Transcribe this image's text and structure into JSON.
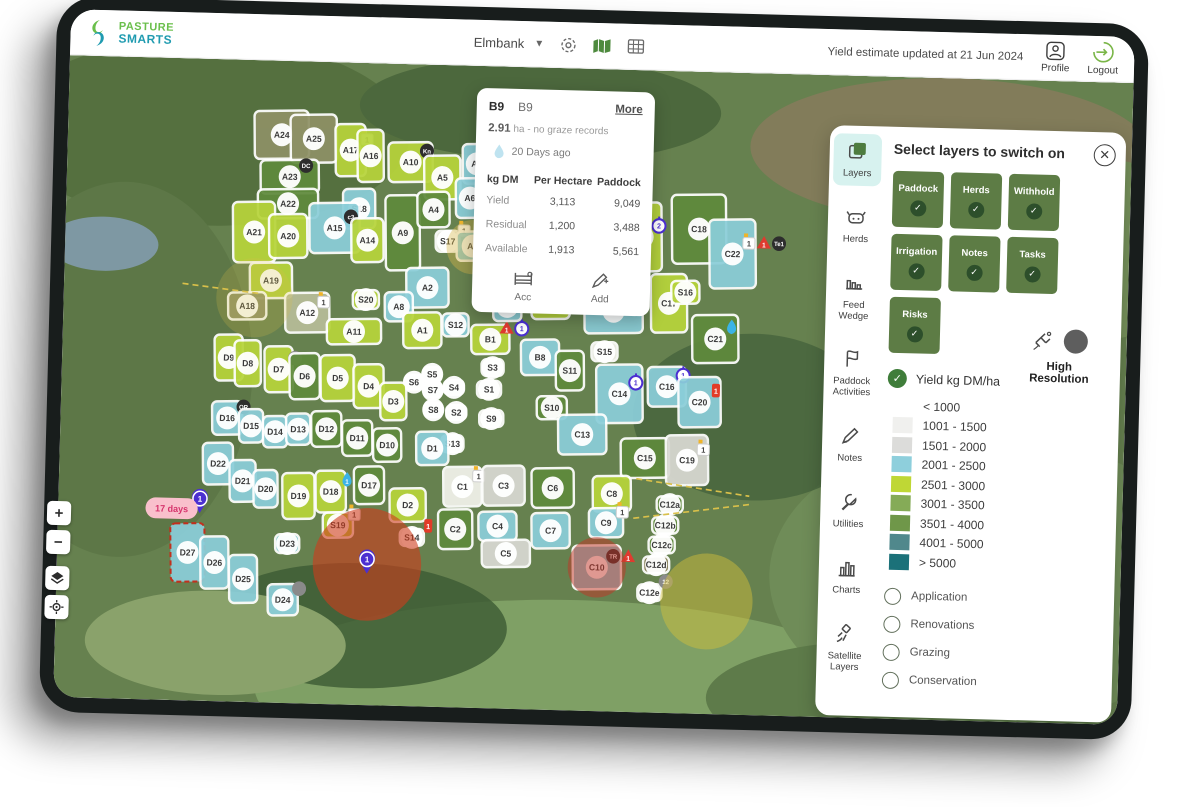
{
  "header": {
    "brand_line1": "PASTURE",
    "brand_line2": "SMARTS",
    "farm_selector": "Elmbank",
    "updated_text": "Yield estimate updated at 21 Jun 2024",
    "profile_label": "Profile",
    "logout_label": "Logout"
  },
  "popup": {
    "tab1": "B9",
    "tab2": "B9",
    "more_label": "More",
    "area_value": "2.91",
    "area_rest": " ha - no graze records",
    "days_ago": "20 Days ago",
    "table": {
      "col1": "kg DM",
      "col2": "Per Hectare",
      "col3": "Paddock",
      "rows": [
        {
          "label": "Yield",
          "per_hectare": "3,113",
          "paddock": "9,049"
        },
        {
          "label": "Residual",
          "per_hectare": "1,200",
          "paddock": "3,488"
        },
        {
          "label": "Available",
          "per_hectare": "1,913",
          "paddock": "5,561"
        }
      ]
    },
    "actions": [
      {
        "label": "Acc",
        "icon": "gate-icon"
      },
      {
        "label": "Add",
        "icon": "edit-icon"
      }
    ]
  },
  "layers_panel": {
    "title": "Select layers to switch on",
    "rail": [
      {
        "label": "Layers",
        "icon": "layers-icon",
        "active": true
      },
      {
        "label": "Herds",
        "icon": "herds-icon",
        "active": false
      },
      {
        "label": "Feed Wedge",
        "icon": "feed-wedge-icon",
        "active": false
      },
      {
        "label": "Paddock Activities",
        "icon": "paddock-activities-icon",
        "active": false
      },
      {
        "label": "Notes",
        "icon": "notes-icon",
        "active": false
      },
      {
        "label": "Utilities",
        "icon": "utilities-icon",
        "active": false
      },
      {
        "label": "Charts",
        "icon": "charts-icon",
        "active": false
      },
      {
        "label": "Satellite Layers",
        "icon": "satellite-layers-icon",
        "active": false
      }
    ],
    "toggles": [
      "Paddock",
      "Herds",
      "Withhold",
      "Irrigation",
      "Notes",
      "Tasks",
      "Risks"
    ],
    "toggle_bg": "#5d7c45",
    "toggle_check_bg": "#2d4f2b",
    "yield_checkbox_label": "Yield kg DM/ha",
    "yield_check_color": "#3f7d3a",
    "high_resolution_label": "High Resolution",
    "high_resolution_dot_color": "#5e5e5e",
    "legend": [
      {
        "label": "< 1000",
        "color": "#ffffff"
      },
      {
        "label": "1001 - 1500",
        "color": "#f0f0ee"
      },
      {
        "label": "1501 - 2000",
        "color": "#dcdcda"
      },
      {
        "label": "2001 - 2500",
        "color": "#8ecfdc"
      },
      {
        "label": "2501 - 3000",
        "color": "#bfd735"
      },
      {
        "label": "3001 - 3500",
        "color": "#85ab57"
      },
      {
        "label": "3501 - 4000",
        "color": "#6f9749"
      },
      {
        "label": "4001 - 5000",
        "color": "#50888c"
      },
      {
        "label": "> 5000",
        "color": "#1b7179"
      }
    ],
    "options": [
      "Application",
      "Renovations",
      "Grazing",
      "Conservation"
    ]
  },
  "map": {
    "scale_label": "100 m",
    "zoom_in": "+",
    "zoom_out": "−",
    "days_pill": "17 days",
    "colors": {
      "lime": "#b7d43b",
      "dgreen": "#5f8a3c",
      "green": "#7da653",
      "blue": "#8bced9",
      "gray": "#d9d9d3",
      "white": "#f2f2ec",
      "olive": "#8e9166",
      "khaki": "#b7bd99",
      "brown": "#8a7f5a"
    },
    "risk_color": "#cf3c1c",
    "irrigation_color": "#d6c23a",
    "paddocks": [
      {
        "id": "A24",
        "x": 213,
        "y": 71,
        "w": 54,
        "h": 46,
        "c": "olive"
      },
      {
        "id": "A25",
        "x": 245,
        "y": 74,
        "w": 46,
        "h": 46,
        "c": "olive"
      },
      {
        "id": "A17",
        "x": 282,
        "y": 84,
        "w": 30,
        "h": 50,
        "c": "lime",
        "b": [
          "f:1"
        ]
      },
      {
        "id": "A16",
        "x": 302,
        "y": 89,
        "w": 26,
        "h": 50,
        "c": "lime"
      },
      {
        "id": "A10",
        "x": 342,
        "y": 94,
        "w": 44,
        "h": 38,
        "c": "lime",
        "b": [
          "k:Kn"
        ]
      },
      {
        "id": "A5",
        "x": 374,
        "y": 108,
        "w": 36,
        "h": 42,
        "c": "lime"
      },
      {
        "id": "A7",
        "x": 408,
        "y": 94,
        "w": 28,
        "h": 38,
        "c": "blue"
      },
      {
        "id": "A23",
        "x": 222,
        "y": 111,
        "w": 58,
        "h": 32,
        "c": "dgreen",
        "b": [
          "k:DC"
        ]
      },
      {
        "id": "A22",
        "x": 221,
        "y": 137,
        "w": 60,
        "h": 28,
        "c": "dgreen"
      },
      {
        "id": "A21",
        "x": 188,
        "y": 165,
        "w": 42,
        "h": 58,
        "c": "lime"
      },
      {
        "id": "A20",
        "x": 222,
        "y": 168,
        "w": 38,
        "h": 42,
        "c": "lime"
      },
      {
        "id": "S18",
        "x": 292,
        "y": 140,
        "w": 32,
        "h": 38,
        "c": "blue"
      },
      {
        "id": "A15",
        "x": 268,
        "y": 159,
        "w": 50,
        "h": 48,
        "c": "blue",
        "b": [
          "k:c3"
        ]
      },
      {
        "id": "A14",
        "x": 301,
        "y": 170,
        "w": 32,
        "h": 42,
        "c": "lime"
      },
      {
        "id": "A9",
        "x": 336,
        "y": 162,
        "w": 34,
        "h": 72,
        "c": "dgreen"
      },
      {
        "id": "A4",
        "x": 366,
        "y": 139,
        "w": 32,
        "h": 34,
        "c": "dgreen"
      },
      {
        "id": "A6",
        "x": 402,
        "y": 127,
        "w": 28,
        "h": 38,
        "c": "blue"
      },
      {
        "id": "A19",
        "x": 206,
        "y": 211,
        "w": 42,
        "h": 34,
        "c": "lime"
      },
      {
        "id": "A18",
        "x": 183,
        "y": 236,
        "w": 38,
        "h": 26,
        "c": "olive"
      },
      {
        "id": "A12",
        "x": 243,
        "y": 241,
        "w": 44,
        "h": 38,
        "c": "khaki",
        "b": [
          "f:1"
        ]
      },
      {
        "id": "S20",
        "x": 301,
        "y": 227,
        "w": 26,
        "h": 18,
        "c": "lime"
      },
      {
        "id": "S17",
        "x": 381,
        "y": 169,
        "w": 24,
        "h": 20,
        "c": "white",
        "b": [
          "f:1"
        ]
      },
      {
        "id": "A3",
        "x": 406,
        "y": 173,
        "w": 32,
        "h": 28,
        "c": "blue",
        "b": [
          "s:1",
          "r:1"
        ]
      },
      {
        "id": "A2",
        "x": 362,
        "y": 214,
        "w": 42,
        "h": 38,
        "c": "blue"
      },
      {
        "id": "A8",
        "x": 334,
        "y": 233,
        "w": 28,
        "h": 28,
        "c": "blue"
      },
      {
        "id": "A1",
        "x": 358,
        "y": 255,
        "w": 38,
        "h": 34,
        "c": "lime"
      },
      {
        "id": "S12",
        "x": 391,
        "y": 249,
        "w": 26,
        "h": 22,
        "c": "blue"
      },
      {
        "id": "A11",
        "x": 290,
        "y": 258,
        "w": 54,
        "h": 24,
        "c": "lime"
      },
      {
        "id": "B1",
        "x": 426,
        "y": 262,
        "w": 38,
        "h": 28,
        "c": "lime",
        "b": [
          "w:1",
          "s:1"
        ]
      },
      {
        "id": "B2",
        "x": 442,
        "y": 230,
        "w": 28,
        "h": 28,
        "c": "blue"
      },
      {
        "id": "B9",
        "x": 485,
        "y": 224,
        "w": 38,
        "h": 34,
        "c": "lime",
        "b": [
          "d:20"
        ]
      },
      {
        "id": "B14",
        "x": 548,
        "y": 232,
        "w": 58,
        "h": 42,
        "c": "blue",
        "b": [
          "s:1"
        ]
      },
      {
        "id": "B15",
        "x": 575,
        "y": 160,
        "w": 38,
        "h": 66,
        "c": "lime",
        "b": [
          "s:2"
        ]
      },
      {
        "id": "B8",
        "x": 476,
        "y": 278,
        "w": 38,
        "h": 34,
        "c": "blue"
      },
      {
        "id": "S15",
        "x": 540,
        "y": 271,
        "w": 26,
        "h": 18,
        "c": "white"
      },
      {
        "id": "S11",
        "x": 506,
        "y": 290,
        "w": 28,
        "h": 38,
        "c": "dgreen"
      },
      {
        "id": "S3",
        "x": 429,
        "y": 289,
        "w": 22,
        "h": 16,
        "c": "white"
      },
      {
        "id": "S1",
        "x": 426,
        "y": 310,
        "w": 24,
        "h": 16,
        "c": "white"
      },
      {
        "id": "S4",
        "x": 391,
        "y": 309,
        "w": 20,
        "h": 14,
        "c": "white"
      },
      {
        "id": "S2",
        "x": 394,
        "y": 333,
        "w": 20,
        "h": 14,
        "c": "white"
      },
      {
        "id": "S9",
        "x": 429,
        "y": 338,
        "w": 24,
        "h": 16,
        "c": "white"
      },
      {
        "id": "S10",
        "x": 489,
        "y": 326,
        "w": 30,
        "h": 22,
        "c": "dgreen"
      },
      {
        "id": "S5",
        "x": 369,
        "y": 297,
        "w": 18,
        "h": 14,
        "c": "white"
      },
      {
        "id": "S6",
        "x": 351,
        "y": 305,
        "w": 18,
        "h": 14,
        "c": "white"
      },
      {
        "id": "S7",
        "x": 370,
        "y": 312,
        "w": 18,
        "h": 14,
        "c": "white"
      },
      {
        "id": "S8",
        "x": 371,
        "y": 331,
        "w": 18,
        "h": 14,
        "c": "white"
      },
      {
        "id": "S13",
        "x": 391,
        "y": 363,
        "w": 22,
        "h": 16,
        "c": "white"
      },
      {
        "id": "C17",
        "x": 603,
        "y": 223,
        "w": 36,
        "h": 56,
        "c": "lime"
      },
      {
        "id": "S16",
        "x": 619,
        "y": 212,
        "w": 28,
        "h": 22,
        "c": "lime"
      },
      {
        "id": "C18",
        "x": 631,
        "y": 151,
        "w": 54,
        "h": 66,
        "c": "dgreen"
      },
      {
        "id": "C22",
        "x": 665,
        "y": 174,
        "w": 46,
        "h": 66,
        "c": "blue",
        "b": [
          "f:1",
          "w:1",
          "k:Te1"
        ]
      },
      {
        "id": "C21",
        "x": 650,
        "y": 256,
        "w": 46,
        "h": 46,
        "c": "dgreen",
        "b": [
          "d:"
        ]
      },
      {
        "id": "C16",
        "x": 603,
        "y": 303,
        "w": 38,
        "h": 38,
        "c": "blue",
        "b": [
          "s:1"
        ]
      },
      {
        "id": "C20",
        "x": 636,
        "y": 317,
        "w": 42,
        "h": 48,
        "c": "blue",
        "b": [
          "r:1"
        ]
      },
      {
        "id": "C14",
        "x": 556,
        "y": 311,
        "w": 46,
        "h": 56,
        "c": "blue",
        "b": [
          "s:1"
        ]
      },
      {
        "id": "C13",
        "x": 520,
        "y": 351,
        "w": 48,
        "h": 38,
        "c": "blue"
      },
      {
        "id": "C15",
        "x": 583,
        "y": 372,
        "w": 48,
        "h": 38,
        "c": "dgreen"
      },
      {
        "id": "C19",
        "x": 625,
        "y": 373,
        "w": 42,
        "h": 48,
        "c": "gray",
        "b": [
          "f:1"
        ]
      },
      {
        "id": "C1",
        "x": 402,
        "y": 404,
        "w": 38,
        "h": 38,
        "c": "white",
        "b": [
          "f:1"
        ]
      },
      {
        "id": "C3",
        "x": 443,
        "y": 402,
        "w": 42,
        "h": 38,
        "c": "gray"
      },
      {
        "id": "C6",
        "x": 492,
        "y": 403,
        "w": 42,
        "h": 38,
        "c": "dgreen"
      },
      {
        "id": "C8",
        "x": 551,
        "y": 407,
        "w": 38,
        "h": 34,
        "c": "lime"
      },
      {
        "id": "C9",
        "x": 546,
        "y": 435,
        "w": 34,
        "h": 28,
        "c": "blue",
        "b": [
          "f:1"
        ]
      },
      {
        "id": "C4",
        "x": 438,
        "y": 441,
        "w": 38,
        "h": 28,
        "c": "blue"
      },
      {
        "id": "C7",
        "x": 491,
        "y": 444,
        "w": 38,
        "h": 34,
        "c": "blue"
      },
      {
        "id": "C5",
        "x": 447,
        "y": 467,
        "w": 48,
        "h": 26,
        "c": "gray"
      },
      {
        "id": "C10",
        "x": 538,
        "y": 478,
        "w": 48,
        "h": 42,
        "c": "blue",
        "b": [
          "k:TR",
          "w:1"
        ]
      },
      {
        "id": "C2",
        "x": 396,
        "y": 445,
        "w": 34,
        "h": 38,
        "c": "dgreen"
      },
      {
        "id": "C12a",
        "x": 609,
        "y": 416,
        "w": 26,
        "h": 16,
        "c": "dgreen"
      },
      {
        "id": "C12b",
        "x": 605,
        "y": 436,
        "w": 26,
        "h": 16,
        "c": "dgreen"
      },
      {
        "id": "C12c",
        "x": 602,
        "y": 455,
        "w": 26,
        "h": 16,
        "c": "dgreen"
      },
      {
        "id": "C12d",
        "x": 597,
        "y": 474,
        "w": 26,
        "h": 16,
        "c": "brown"
      },
      {
        "id": "C12e",
        "x": 591,
        "y": 501,
        "w": 24,
        "h": 16,
        "c": "white",
        "b": [
          "m:12"
        ]
      },
      {
        "id": "D9",
        "x": 166,
        "y": 286,
        "w": 28,
        "h": 44,
        "c": "lime"
      },
      {
        "id": "D8",
        "x": 185,
        "y": 291,
        "w": 26,
        "h": 44,
        "c": "lime"
      },
      {
        "id": "D7",
        "x": 216,
        "y": 296,
        "w": 28,
        "h": 44,
        "c": "lime",
        "b": [
          "m:"
        ]
      },
      {
        "id": "D6",
        "x": 242,
        "y": 302,
        "w": 30,
        "h": 44,
        "c": "dgreen"
      },
      {
        "id": "D5",
        "x": 275,
        "y": 303,
        "w": 34,
        "h": 44,
        "c": "lime"
      },
      {
        "id": "D4",
        "x": 306,
        "y": 310,
        "w": 30,
        "h": 42,
        "c": "lime"
      },
      {
        "id": "D3",
        "x": 331,
        "y": 324,
        "w": 26,
        "h": 36,
        "c": "lime"
      },
      {
        "id": "D16",
        "x": 166,
        "y": 344,
        "w": 30,
        "h": 32,
        "c": "blue",
        "b": [
          "k:OR"
        ]
      },
      {
        "id": "D15",
        "x": 190,
        "y": 351,
        "w": 24,
        "h": 32,
        "c": "blue"
      },
      {
        "id": "D14",
        "x": 214,
        "y": 356,
        "w": 24,
        "h": 30,
        "c": "blue"
      },
      {
        "id": "D13",
        "x": 237,
        "y": 353,
        "w": 24,
        "h": 30,
        "c": "blue"
      },
      {
        "id": "D12",
        "x": 265,
        "y": 352,
        "w": 30,
        "h": 34,
        "c": "dgreen"
      },
      {
        "id": "D11",
        "x": 296,
        "y": 360,
        "w": 30,
        "h": 34,
        "c": "dgreen"
      },
      {
        "id": "D10",
        "x": 326,
        "y": 366,
        "w": 28,
        "h": 32,
        "c": "dgreen"
      },
      {
        "id": "D1",
        "x": 371,
        "y": 368,
        "w": 32,
        "h": 32,
        "c": "blue"
      },
      {
        "id": "D22",
        "x": 158,
        "y": 388,
        "w": 30,
        "h": 40,
        "c": "blue"
      },
      {
        "id": "D21",
        "x": 183,
        "y": 404,
        "w": 26,
        "h": 40,
        "c": "blue"
      },
      {
        "id": "D20",
        "x": 206,
        "y": 411,
        "w": 24,
        "h": 36,
        "c": "blue"
      },
      {
        "id": "D19",
        "x": 239,
        "y": 417,
        "w": 32,
        "h": 44,
        "c": "lime"
      },
      {
        "id": "D18",
        "x": 271,
        "y": 412,
        "w": 30,
        "h": 40,
        "c": "lime",
        "b": [
          "d:1"
        ]
      },
      {
        "id": "D17",
        "x": 309,
        "y": 405,
        "w": 30,
        "h": 36,
        "c": "dgreen"
      },
      {
        "id": "D2",
        "x": 348,
        "y": 423,
        "w": 36,
        "h": 32,
        "c": "lime"
      },
      {
        "id": "S19",
        "x": 279,
        "y": 444,
        "w": 30,
        "h": 24,
        "c": "lime",
        "b": [
          "f:1"
        ]
      },
      {
        "id": "S14",
        "x": 353,
        "y": 454,
        "w": 24,
        "h": 16,
        "c": "white",
        "b": [
          "r:1"
        ]
      },
      {
        "id": "D23",
        "x": 229,
        "y": 463,
        "w": 24,
        "h": 18,
        "c": "blue"
      },
      {
        "id": "D27",
        "x": 130,
        "y": 474,
        "w": 34,
        "h": 56,
        "c": "blue",
        "dash": true
      },
      {
        "id": "D26",
        "x": 157,
        "y": 483,
        "w": 28,
        "h": 50,
        "c": "blue"
      },
      {
        "id": "D25",
        "x": 186,
        "y": 498,
        "w": 28,
        "h": 46,
        "c": "blue"
      },
      {
        "id": "D24",
        "x": 226,
        "y": 517,
        "w": 30,
        "h": 30,
        "c": "blue",
        "b": [
          "m:"
        ]
      }
    ],
    "overlays": [
      {
        "t": "glow",
        "x": 406,
        "y": 174,
        "r": 26,
        "fill": "#d9b64a",
        "o": 0.4
      },
      {
        "t": "glow",
        "x": 190,
        "y": 228,
        "r": 38,
        "fill": "#d9c04a",
        "o": 0.22
      },
      {
        "t": "circle",
        "x": 309,
        "y": 481,
        "r": 54,
        "fill": "#cf3c1c",
        "o": 0.6
      },
      {
        "t": "circle",
        "x": 538,
        "y": 478,
        "r": 29,
        "fill": "#c43326",
        "o": 0.5
      },
      {
        "t": "circle",
        "x": 648,
        "y": 508,
        "r": 46,
        "fill": "#d6c23a",
        "o": 0.45
      },
      {
        "t": "line",
        "x1": 575,
        "y1": 392,
        "x2": 688,
        "y2": 406
      },
      {
        "t": "line",
        "x1": 573,
        "y1": 430,
        "x2": 688,
        "y2": 414
      },
      {
        "t": "line",
        "x1": 118,
        "y1": 216,
        "x2": 196,
        "y2": 224
      },
      {
        "t": "pin",
        "x": 309,
        "y": 478,
        "label": "1"
      },
      {
        "t": "pin",
        "x": 141,
        "y": 424,
        "label": "1"
      },
      {
        "t": "pill",
        "x": 113,
        "y": 432,
        "label": "17 days"
      }
    ]
  }
}
